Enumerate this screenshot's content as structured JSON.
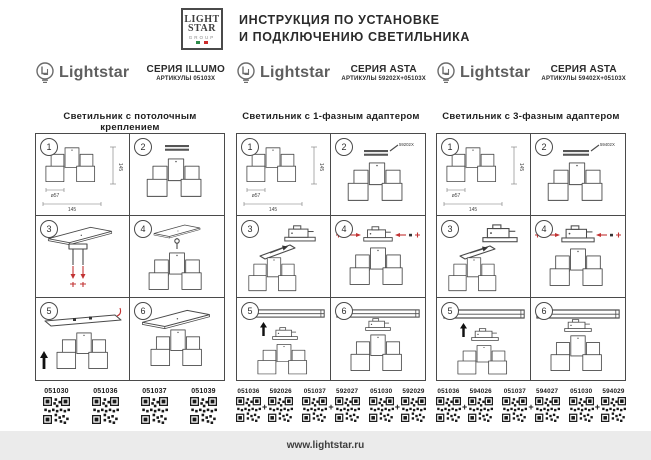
{
  "header": {
    "logo_lines": [
      "LIGHT",
      "STAR",
      "GROUP"
    ],
    "title_line1": "ИНСТРУКЦИЯ  ПО  УСТАНОВКЕ",
    "title_line2": "И ПОДКЛЮЧЕНИЮ СВЕТИЛЬНИКА"
  },
  "step_numbers": [
    "1",
    "2",
    "3",
    "4",
    "5",
    "6"
  ],
  "dims": {
    "diameter": "ø57",
    "width": "145",
    "height": "145"
  },
  "plus_sign": "+",
  "columns": [
    {
      "brand": "Lightstar",
      "series": "СЕРИЯ ILLUMO",
      "articles": "АРТИКУЛЫ 05103X",
      "title": "Светильник с потолочным креплением",
      "qr_labels": [
        "051030",
        "051036",
        "051037",
        "051039"
      ]
    },
    {
      "brand": "Lightstar",
      "series": "СЕРИЯ ASTA",
      "articles": "АРТИКУЛЫ 59202X+05103X",
      "title": "Светильник с 1-фазным адаптером",
      "adapter_label": "59202X",
      "qr_pairs": [
        [
          "051036",
          "592026"
        ],
        [
          "051037",
          "592027"
        ],
        [
          "051030",
          "592029"
        ]
      ]
    },
    {
      "brand": "Lightstar",
      "series": "СЕРИЯ ASTA",
      "articles": "АРТИКУЛЫ 59402X+05103X",
      "title": "Светильник с 3-фазным адаптером",
      "adapter_label": "59402X",
      "qr_pairs": [
        [
          "051036",
          "594026"
        ],
        [
          "051037",
          "594027"
        ],
        [
          "051030",
          "594029"
        ]
      ]
    }
  ],
  "footer": {
    "url": "www.lightstar.ru"
  },
  "colors": {
    "accent_red": "#c23333",
    "line": "#4a4a4a",
    "footer_bg": "#ebebeb"
  }
}
